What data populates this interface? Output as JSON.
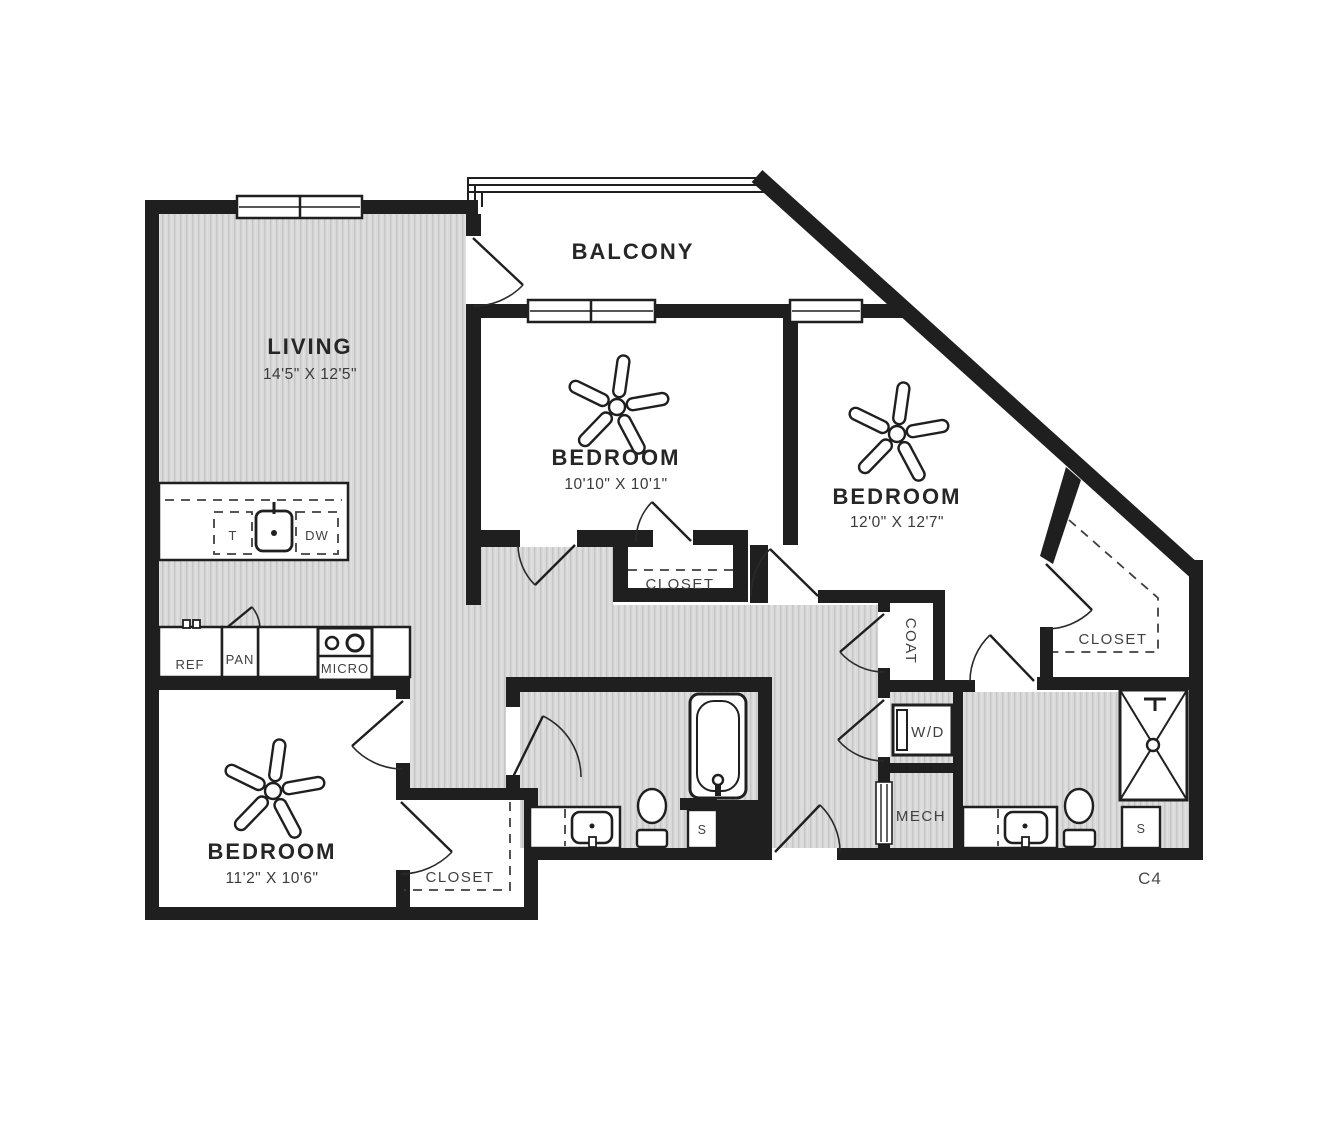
{
  "plan": {
    "unit_label": "C4",
    "rooms": {
      "living": {
        "name": "LIVING",
        "dims": "14'5\" X 12'5\""
      },
      "balcony": {
        "name": "BALCONY",
        "dims": ""
      },
      "bedroom_middle": {
        "name": "BEDROOM",
        "dims": "10'10\" X 10'1\""
      },
      "bedroom_right": {
        "name": "BEDROOM",
        "dims": "12'0\" X 12'7\""
      },
      "bedroom_lower": {
        "name": "BEDROOM",
        "dims": "11'2\" X 10'6\""
      }
    },
    "labels": {
      "closet_middle": "CLOSET",
      "closet_walkin": "CLOSET",
      "closet_lower": "CLOSET",
      "coat": "COAT",
      "washer_dryer": "W/D",
      "mech": "MECH",
      "fridge": "REF",
      "pantry": "PAN",
      "microwave": "MICRO",
      "trash": "T",
      "dishwasher": "DW",
      "shelf_bath1": "S",
      "shelf_bath2": "S"
    },
    "colors": {
      "wall": "#1f1f1f",
      "floor_base": "#d9d9d9",
      "floor_stripe": "#c6c6c6",
      "room_text": "#262626",
      "label_text": "#414141"
    }
  }
}
